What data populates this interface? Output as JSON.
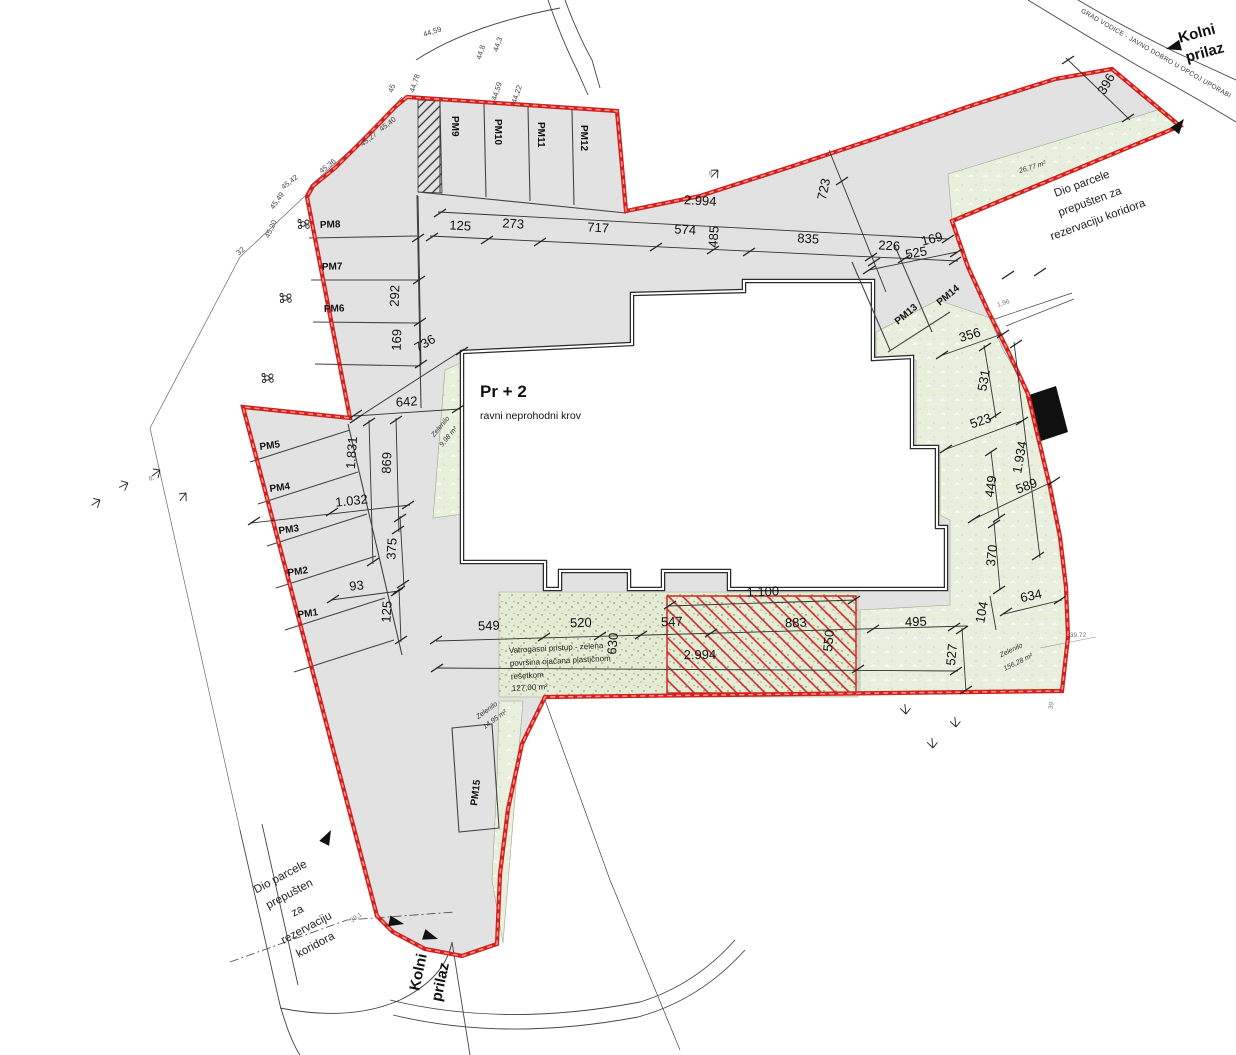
{
  "building": {
    "title": "Pr + 2",
    "subtitle": "ravni neprohodni krov"
  },
  "parking": {
    "pm1": "PM1",
    "pm2": "PM2",
    "pm3": "PM3",
    "pm4": "PM4",
    "pm5": "PM5",
    "pm6": "PM6",
    "pm7": "PM7",
    "pm8": "PM8",
    "pm9": "PM9",
    "pm10": "PM10",
    "pm11": "PM11",
    "pm12": "PM12",
    "pm13": "PM13",
    "pm14": "PM14",
    "pm15": "PM15"
  },
  "dims": {
    "d125": "125",
    "d273": "273",
    "d717": "717",
    "d574": "574",
    "d485": "485",
    "d835": "835",
    "d226": "226",
    "d169": "169",
    "d2994": "2.994",
    "d723": "723",
    "d525": "525",
    "d292": "292",
    "d169b": "169",
    "d736": "736",
    "d642": "642",
    "d869": "869",
    "d1831": "1.831",
    "d1032": "1.032",
    "d375": "375",
    "d93": "93",
    "d125b": "125",
    "d549": "549",
    "d520": "520",
    "d630": "630",
    "d547": "547",
    "d883": "883",
    "d550": "550",
    "d2994b": "2.994",
    "d1100": "1.100",
    "d495": "495",
    "d527": "527",
    "d104": "104",
    "d634": "634",
    "d356": "356",
    "d531": "531",
    "d523": "523",
    "d1934": "1.934",
    "d449": "449",
    "d589": "589",
    "d370": "370",
    "d396": "396",
    "d196": "1,96"
  },
  "elevations": {
    "e1": "45,20",
    "e2": "45,49",
    "e3": "45,42",
    "e4": "45,36",
    "e5": "45,27",
    "e6": "45,40",
    "e7": "45",
    "e8": "44,78",
    "e9": "44,59",
    "e10": "44,8",
    "e11": "44,3",
    "e12": "44,22",
    "e13": "44,59",
    "e14": "32",
    "e15": "39,72",
    "e16": "39",
    "e17": "39,1",
    "m8": "8,"
  },
  "zelenilo": {
    "label": "Zelenilo",
    "z1": "9,98 m²",
    "z2": "26,77 m²",
    "z3": "156,28 m²",
    "z4": "14,95 m²"
  },
  "notes": {
    "vatrogasni_1": "Vatrogasni pristup - zelena",
    "vatrogasni_2": "površina ojačana plastičnom",
    "vatrogasni_3": "rešetkom",
    "vatrogasni_4": "127,00 m²",
    "dio_tr_1": "Dio parcele",
    "dio_tr_2": "prepušten za",
    "dio_tr_3": "rezervaciju koridora",
    "dio_bl_1": "Dio parcele",
    "dio_bl_2": "prepušten",
    "dio_bl_3": "za",
    "dio_bl_4": "rezervaciju",
    "dio_bl_5": "koridora",
    "grad_vodice": "GRAD VODICE - JAVNO DOBRO U OPĆOJ UPORABI",
    "kolni_1": "Kolni",
    "kolni_2": "prilaz"
  },
  "colors": {
    "boundary": "#d21f1f",
    "paving": "#e2e2e2",
    "green": "#e9efdd",
    "fire_green": "#e4ecd4",
    "hatch_red": "#cc2a2a",
    "wall": "#2b2b2b"
  }
}
